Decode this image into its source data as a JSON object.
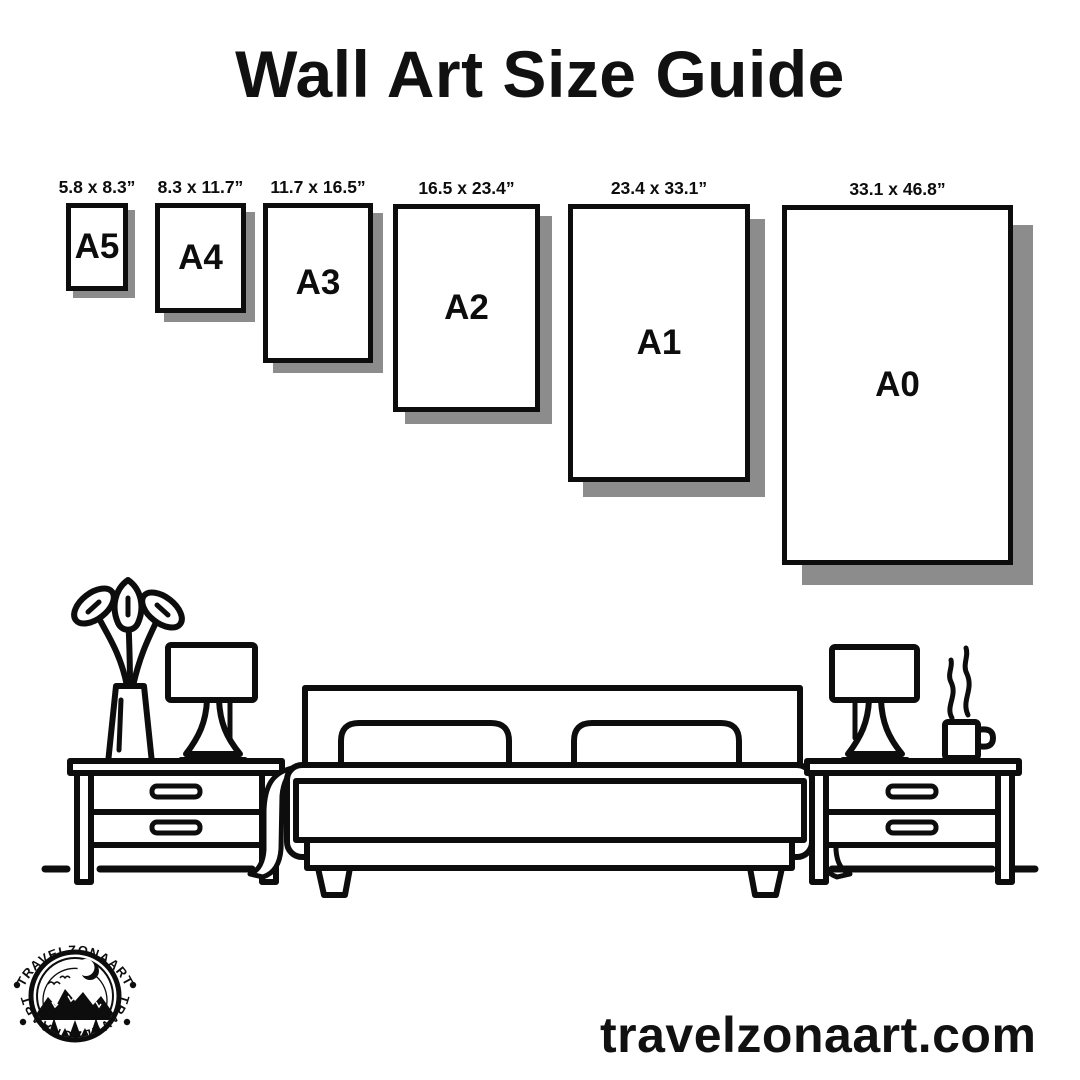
{
  "title": "Wall Art Size Guide",
  "posters": [
    {
      "name": "A5",
      "dims": "5.8 x 8.3”"
    },
    {
      "name": "A4",
      "dims": "8.3 x 11.7”"
    },
    {
      "name": "A3",
      "dims": "11.7 x 16.5”"
    },
    {
      "name": "A2",
      "dims": "16.5 x 23.4”"
    },
    {
      "name": "A1",
      "dims": "23.4 x 33.1”"
    },
    {
      "name": "A0",
      "dims": "33.1 x 46.8”"
    }
  ],
  "brand": {
    "badge_text": "TRAVELZONAART",
    "website": "travelzonaart.com"
  },
  "colors": {
    "ink": "#0d0d0d",
    "poster_shadow": "#8c8c8c",
    "background": "#ffffff"
  },
  "icons": {
    "badge": "travelzonaart-mountain-badge",
    "scene": "bedroom-furniture-line-art"
  }
}
